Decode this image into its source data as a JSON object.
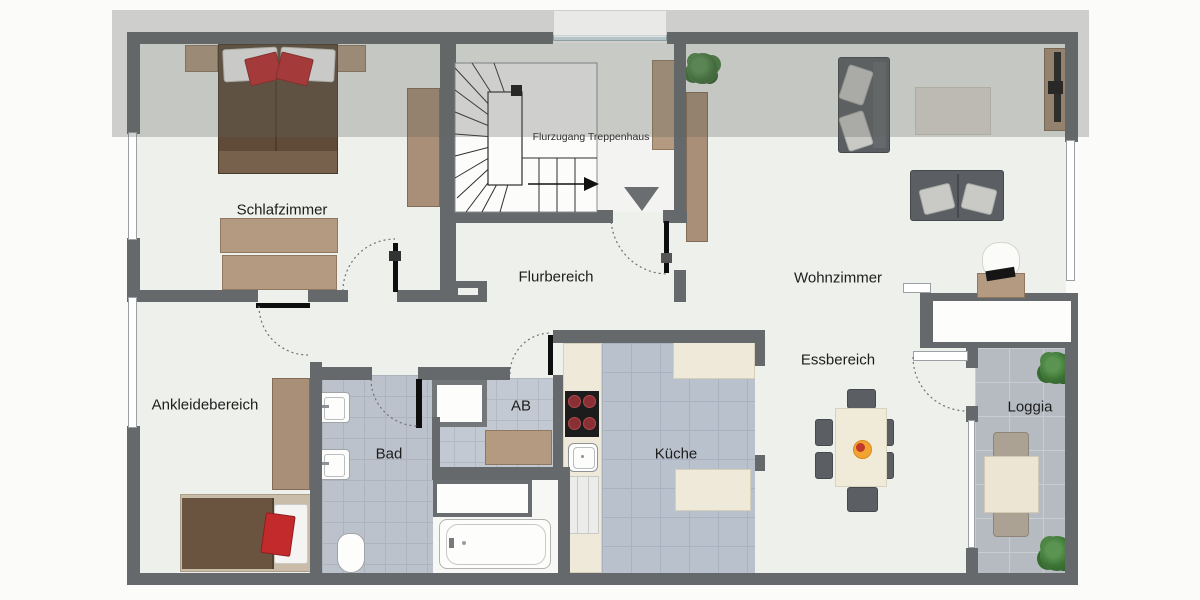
{
  "plan": {
    "rooms": {
      "schlafzimmer": {
        "label": "Schlafzimmer"
      },
      "flurbereich": {
        "label": "Flurbereich"
      },
      "wohnzimmer": {
        "label": "Wohnzimmer"
      },
      "ankleidebereich": {
        "label": "Ankleidebereich"
      },
      "bad": {
        "label": "Bad"
      },
      "ab": {
        "label": "AB"
      },
      "kueche": {
        "label": "Küche"
      },
      "essbereich": {
        "label": "Essbereich"
      },
      "loggia": {
        "label": "Loggia"
      }
    },
    "annotations": {
      "stair_access": "Flurzugang Treppenhaus"
    },
    "colors": {
      "wall": "#66696c",
      "floor": "#eef0ec",
      "wood": "#b49a81",
      "accent_red": "#c22a2c",
      "sofa": "#5b5f63",
      "cream_furniture": "#efe9da",
      "tile_bath": "#bcc2cb",
      "tile_kitchen": "#b9c1cd",
      "tile_loggia": "#b6bac1",
      "upper_floor_overlay": "rgba(95,99,94,0.29)"
    },
    "icons": [
      "staircase-icon",
      "entrance-arrow-icon",
      "double-bed-icon",
      "single-bed-icon",
      "sofa-icon",
      "dining-table-icon",
      "plant-icon",
      "bathtub-icon",
      "shower-icon",
      "sink-icon",
      "toilet-icon",
      "washing-machine-icon",
      "cooktop-icon",
      "tv-board-icon",
      "desk-chair-icon",
      "door-swing-icon",
      "window-icon"
    ]
  }
}
